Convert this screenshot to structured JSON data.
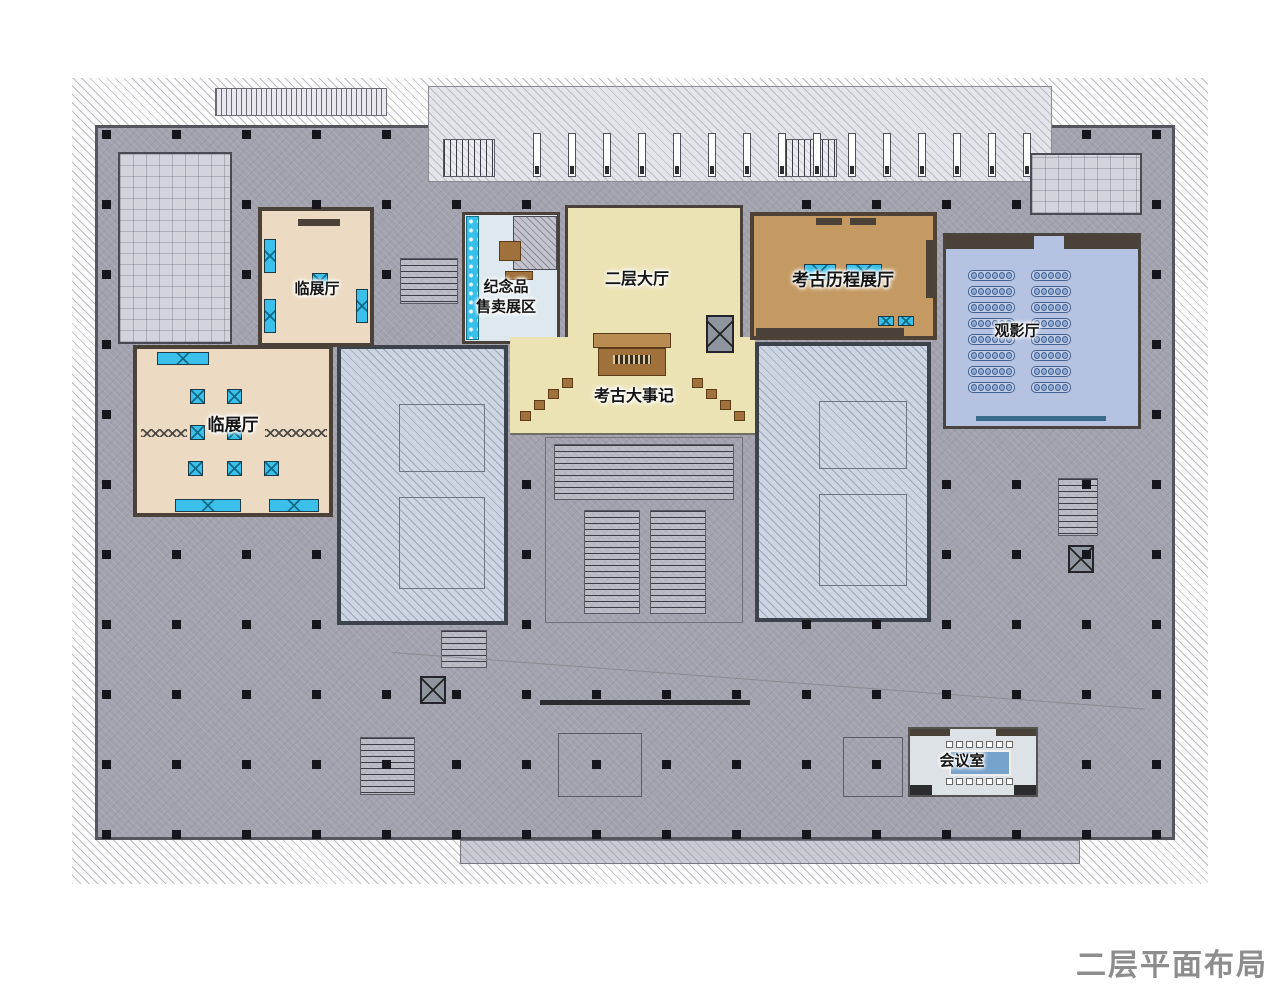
{
  "title": "二层平面布局图",
  "rooms": {
    "linzhan_upper": {
      "label": "临展厅"
    },
    "linzhan_lower": {
      "label": "临展厅"
    },
    "souvenir": {
      "line1": "纪念品",
      "line2": "售卖展区"
    },
    "hall": {
      "label": "二层大厅"
    },
    "chronicle": {
      "label": "考古大事记"
    },
    "archaeology": {
      "label": "考古历程展厅"
    },
    "cinema": {
      "label": "观影厅"
    },
    "meeting": {
      "label": "会议室"
    }
  },
  "colors": {
    "floor_gray": "#a1a2ae",
    "exhibit_cream": "#ecdbc2",
    "hall_yellow": "#ece3b5",
    "archaeology_tan": "#c49a62",
    "cinema_blue": "#b5c2e2",
    "souvenir_blue": "#dde9ef",
    "courtyard_blue_gray": "#ccd5e1",
    "display_case_cyan": "#3ac0ea",
    "meeting_table_blue": "#76a3cb",
    "wall_dark": "#4a4138",
    "title_gray": "#8d8d8d"
  }
}
